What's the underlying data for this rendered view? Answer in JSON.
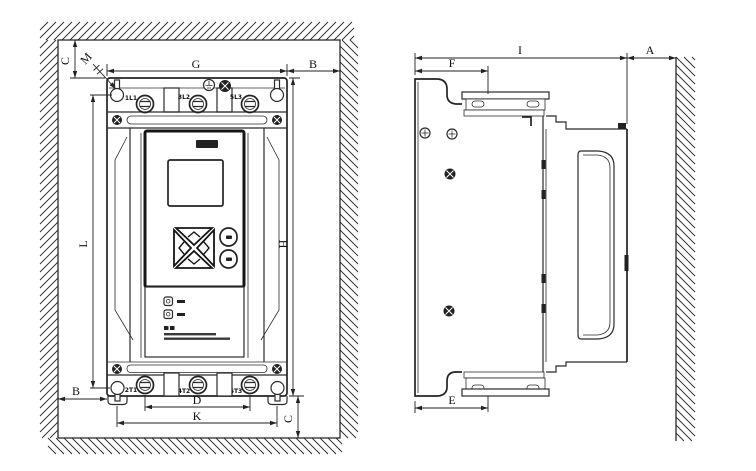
{
  "front_view": {
    "dims": {
      "top_clearance": "C",
      "mounting_hole": "M",
      "width": "G",
      "clearance_right": "B",
      "mounting_pitch_vertical": "L",
      "height": "H",
      "clearance_left": "B",
      "terminal_pitch": "D",
      "mounting_pitch_horizontal": "K",
      "bottom_clearance": "C"
    },
    "terminals_top": [
      "1L1",
      "3L2",
      "5L3"
    ],
    "terminals_bottom": [
      "2T1",
      "4T2",
      "6T3"
    ]
  },
  "side_view": {
    "dims": {
      "flange_depth_top": "F",
      "total_depth": "I",
      "wall_clearance": "A",
      "flange_depth_bottom": "E"
    }
  },
  "colors": {
    "line": "#2b2b2b",
    "background": "#ffffff"
  }
}
